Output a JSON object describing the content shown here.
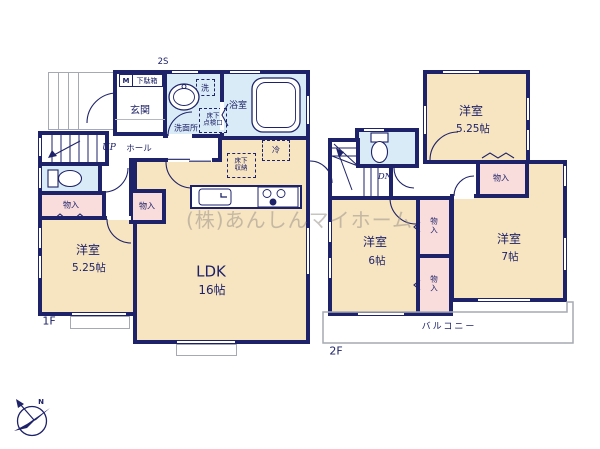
{
  "palette": {
    "wall": "#1e2268",
    "room_cream": "#f7e4c0",
    "wet_blue": "#d9ebf7",
    "closet_pink": "#f9dcdc",
    "outline_gray": "#a6a9b4",
    "watermark": "#9a948a"
  },
  "watermark": "(株)あんしんマイホーム",
  "compass": {
    "north": "N"
  },
  "floor1": {
    "name": "1F",
    "annotation": "2S",
    "labels": {
      "meter": "M",
      "shoe_cabinet": "下駄箱",
      "entrance": "玄関",
      "washroom": "洗面所",
      "laundry": "洗",
      "bathroom": "浴室",
      "underfloor_access": "床下\n点検口",
      "fridge": "冷",
      "underfloor_storage": "床下\n収納",
      "stairs_up": "UP",
      "hall": "ホール",
      "closet_a": "物入",
      "closet_b": "物入",
      "bedroom": "洋室",
      "bedroom_size": "5.25帖",
      "ldk": "LDK",
      "ldk_size": "16帖"
    }
  },
  "floor2": {
    "name": "2F",
    "labels": {
      "stairs_down": "DN",
      "bedroom_a": "洋室",
      "bedroom_a_size": "5.25帖",
      "closet_hall": "物入",
      "closet_b": "物\n入",
      "closet_c": "物\n入",
      "bedroom_b": "洋室",
      "bedroom_b_size": "6帖",
      "bedroom_c": "洋室",
      "bedroom_c_size": "7帖",
      "balcony": "バルコニー"
    }
  }
}
